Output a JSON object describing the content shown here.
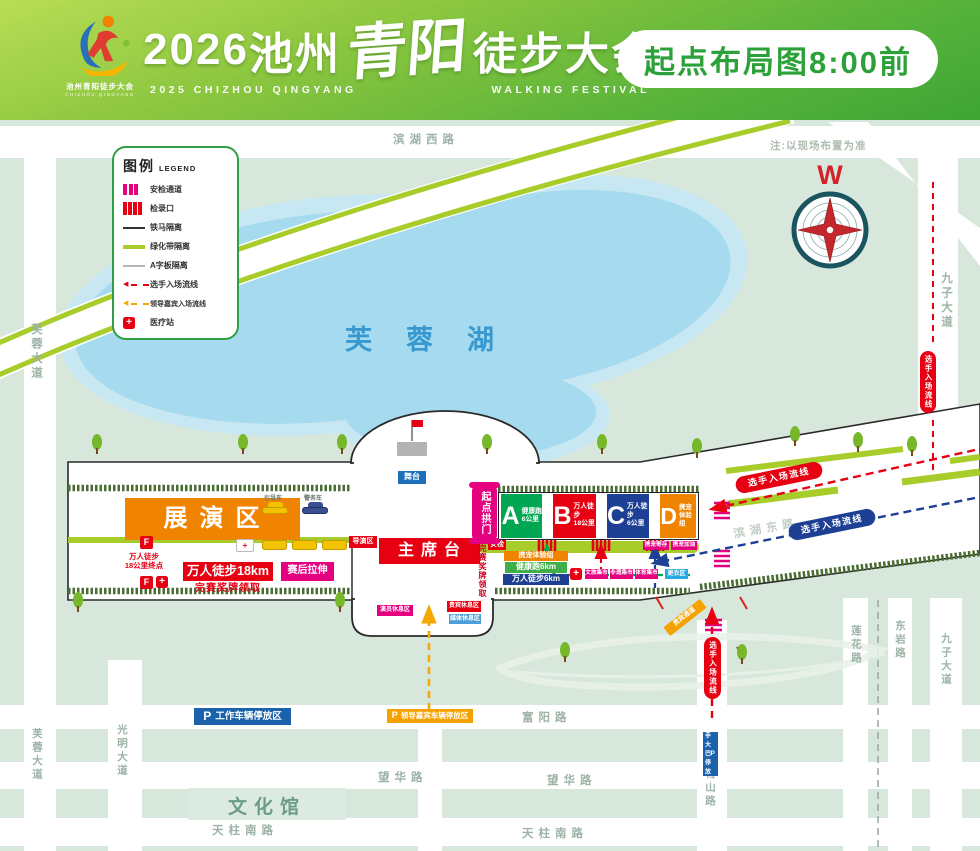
{
  "header": {
    "year": "2026",
    "city": "池州",
    "brand": "青阳",
    "event": "徒步大会",
    "sub_left": "2025 CHIZHOU QINGYANG",
    "sub_right": "WALKING FESTIVAL",
    "badge": "起点布局图8:00前",
    "logo_text": "池州青阳徒步大会",
    "logo_sub": "CHIZHOU QINGYANG"
  },
  "legend": {
    "title": "图例",
    "title_en": "LEGEND",
    "items": [
      {
        "key": "security-lane",
        "label": "安检通道"
      },
      {
        "key": "checkin-gate",
        "label": "检录口"
      },
      {
        "key": "iron-barrier",
        "label": "铁马隔离"
      },
      {
        "key": "green-belt",
        "label": "绿化带隔离"
      },
      {
        "key": "a-board",
        "label": "A字板隔离"
      },
      {
        "key": "athlete-flow",
        "label": "选手入场流线"
      },
      {
        "key": "vip-flow",
        "label": "领导嘉宾入场流线"
      },
      {
        "key": "medical",
        "label": "医疗站"
      }
    ]
  },
  "map": {
    "note": "注:以现场布置为准",
    "compass": "W",
    "lake": "芙蓉湖",
    "roads": {
      "binhu_west": "滨湖西路",
      "furong_top": "芙蓉大道",
      "jiuzi_top": "九子大道",
      "binhu_east": "滨湖东路",
      "lianhua": "莲花路",
      "dongyan": "东岩路",
      "jiuzi_bottom": "九子大道",
      "jishan": "吉山路",
      "fuyang": "富阳路",
      "wanghua_left": "望华路",
      "wanghua_right": "望华路",
      "tianzhu_left": "天柱南路",
      "tianzhu_right": "天柱南路",
      "guangming": "光明大道",
      "furong_bottom": "芙蓉大道"
    },
    "zones": [
      {
        "letter": "A",
        "line1": "健康跑",
        "line2": "6公里",
        "color": "#00a651"
      },
      {
        "letter": "B",
        "line1": "万人徒步",
        "line2": "18公里",
        "color": "#e60012"
      },
      {
        "letter": "C",
        "line1": "万人徒步",
        "line2": "6公里",
        "color": "#1d3f94"
      },
      {
        "letter": "D",
        "line1": "携宠",
        "line2": "体验组",
        "color": "#f08300"
      }
    ],
    "facilities": {
      "stage_area": "展演区",
      "rostrum": "主席台",
      "start_arch": "起点拱门",
      "stage": "舞台",
      "director_area": "导演区",
      "security_check": "安检",
      "finish_line1": "万人徒步",
      "finish_line2": "18公里终点",
      "f_marker": "F",
      "walk18_box": "万人徒步18km",
      "medal_text": "完赛奖牌领取",
      "medal_vertical": "完赛奖牌领取",
      "stretch_box": "赛后拉伸",
      "pet_group_box": "携宠体验组",
      "health_run_box": "健康跑6km",
      "walk6_box": "万人徒步6km",
      "market_1": "文旅集市",
      "market_2": "非遗集市",
      "market_3": "体育集市",
      "changing_area": "更衣区",
      "pet_deposit": "携宠寄存",
      "pet_fuel": "携宠加油",
      "rest_performer": "演员休息区",
      "rest_vip": "贵宾休息区",
      "rest_media": "媒体休息区",
      "vip_channel": "贵宾通道",
      "car_lead": "引导车",
      "car_police": "警务车",
      "culture_hall": "文化馆"
    },
    "flows": {
      "athlete": "选手入场流线"
    },
    "parking": {
      "p": "P",
      "work": "工作车辆停放区",
      "vip": "领导嘉宾车辆停放区",
      "bus": "选手大巴停放区"
    },
    "colors": {
      "accent_green": "#3aa335",
      "magenta": "#e5007f",
      "red": "#e60012",
      "blue": "#1d3f94",
      "orange": "#f08300",
      "chartreuse": "#a8cc29",
      "lake": "#a6daee"
    }
  }
}
